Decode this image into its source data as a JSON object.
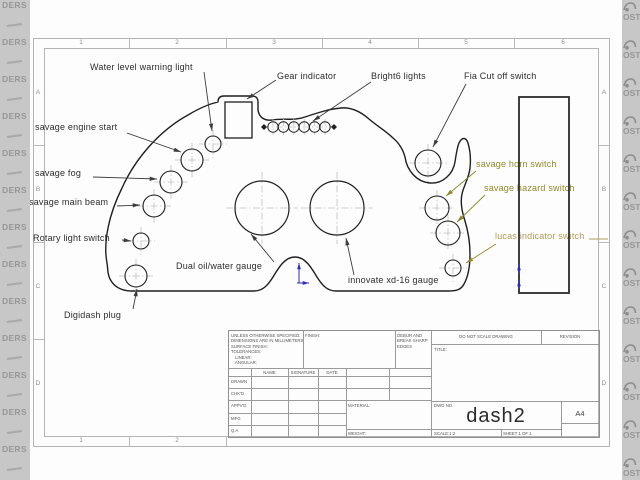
{
  "watermark": {
    "left_text": "DERS",
    "right_text": "OST",
    "right_glyph_icon": "car-doodle-icon"
  },
  "sheet": {
    "zone_numbers_top": [
      "1",
      "2",
      "3",
      "4",
      "5",
      "6"
    ],
    "zone_numbers_bottom": [
      "1",
      "2"
    ],
    "zone_letters": [
      "A",
      "B",
      "C",
      "D"
    ]
  },
  "labels": {
    "water_level": "Water level warning light",
    "gear": "Gear indicator",
    "bright6": "Bright6 lights",
    "fia": "Fia Cut off switch",
    "engine_start": "savage engine start",
    "fog": "savage fog",
    "main_beam": "savage main beam",
    "rotary": "Rotary light switch",
    "digidash": "Digidash plug",
    "dual_gauge": "Dual oil/water gauge",
    "innovate": "innovate xd-16 gauge",
    "horn": "savage horn switch",
    "hazard": "savage hazard switch",
    "lucas": "lucas indicator switch"
  },
  "title_block": {
    "spec_lines": [
      "UNLESS OTHERWISE SPECIFIED:",
      "DIMENSIONS ARE IN MILLIMETERS",
      "SURFACE FINISH:",
      "TOLERANCES:",
      "LINEAR:",
      "ANGULAR:"
    ],
    "finish_label": "FINISH:",
    "debur_lines": [
      "DEBUR AND",
      "BREAK SHARP",
      "EDGES"
    ],
    "do_not_scale": "DO NOT SCALE DRAWING",
    "revision_label": "REVISION",
    "sign_columns": [
      "NAME",
      "SIGNATURE",
      "DATE"
    ],
    "sign_rows": [
      "DRAWN",
      "CHK'D",
      "APPV'D",
      "MFG",
      "Q.A"
    ],
    "title_label": "TITLE:",
    "material_label": "MATERIAL:",
    "weight_label": "WEIGHT:",
    "dwg_label": "DWG NO.",
    "drawing_number": "dash2",
    "paper_size": "A4",
    "scale_label": "SCALE:1:2",
    "sheet_label": "SHEET 1 OF 1"
  },
  "colors": {
    "watermark_bg": "#c7c7c7",
    "drawing_line": "#1f1f1f",
    "border_line": "#b4b4b4",
    "olive_label": "#8f8a2b",
    "khaki_label": "#b09a58",
    "origin_blue": "#2a2ac0"
  }
}
